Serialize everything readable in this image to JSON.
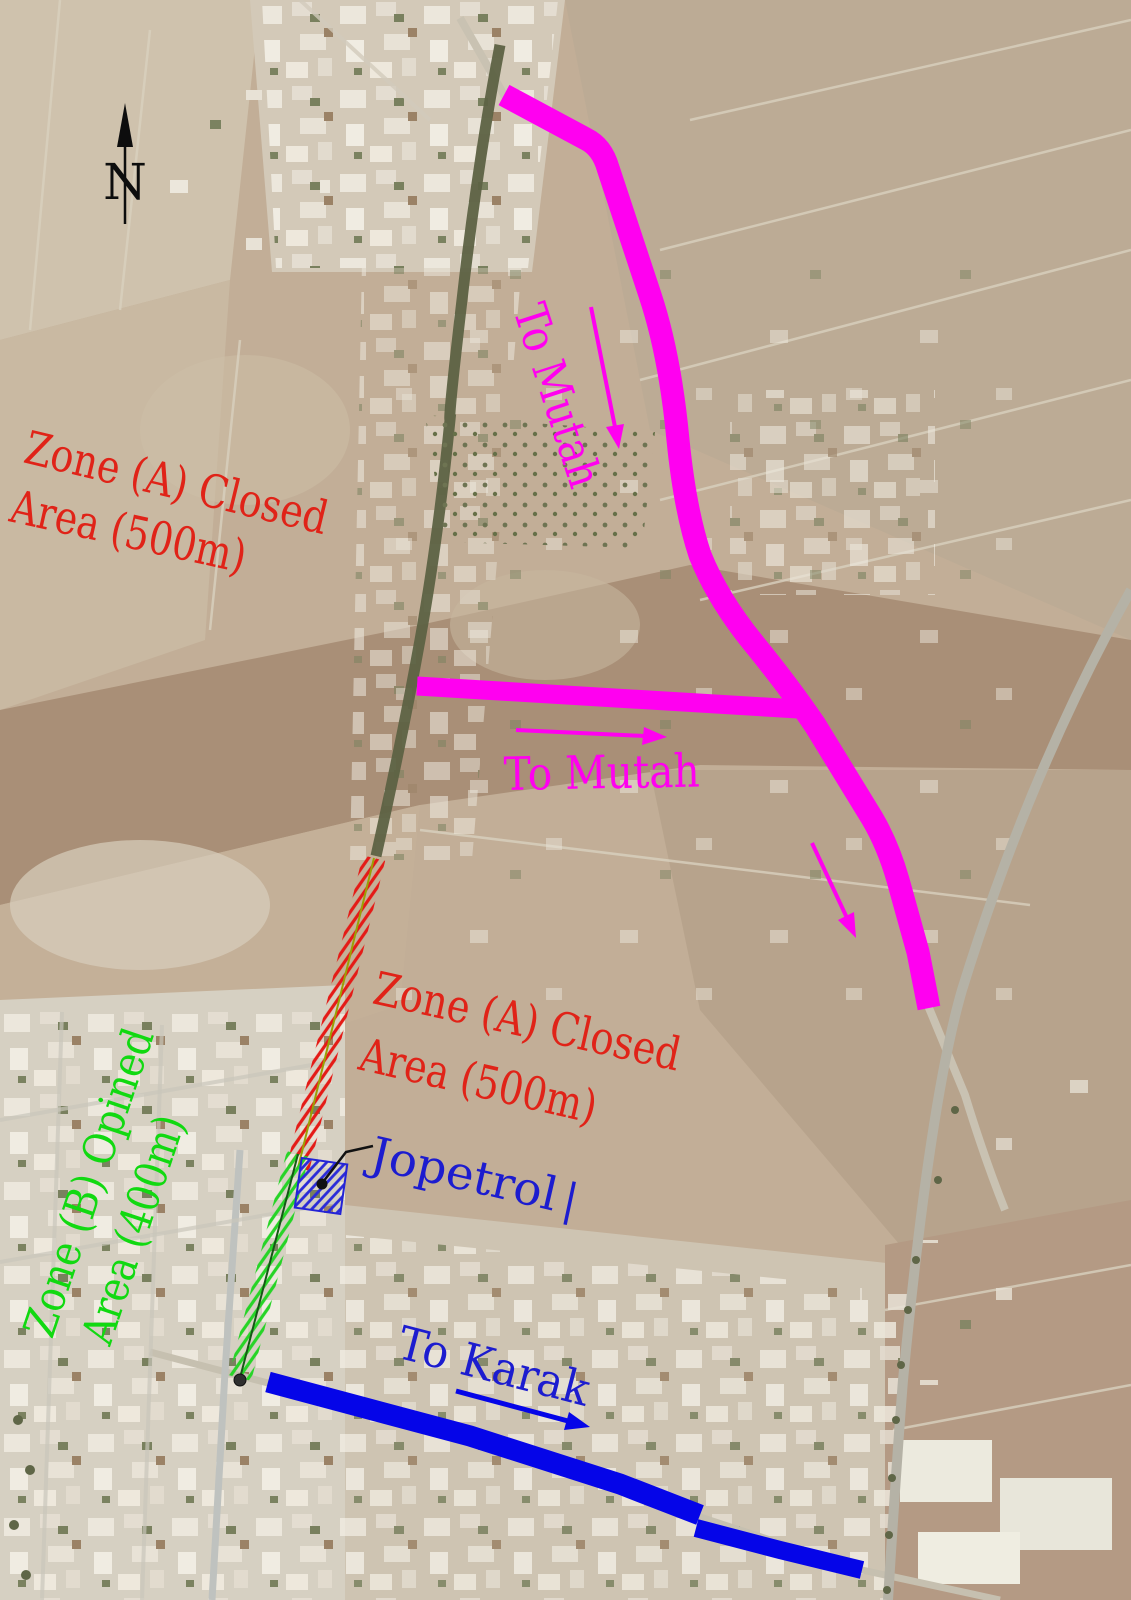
{
  "map": {
    "kind": "satellite annotation map - road closure and detour plan",
    "compass": {
      "label": "N"
    },
    "zones": {
      "zone_a_upper": {
        "line1": "Zone (A) Closed",
        "line2": "Area (500m)"
      },
      "zone_a_road": {
        "line1": "Zone (A) Closed",
        "line2": "Area (500m)"
      },
      "zone_b": {
        "line1": "Zone (B) Opined",
        "line2": "Area (400m)"
      }
    },
    "routes": {
      "to_mutah_upper": {
        "label": "To Mutah"
      },
      "to_mutah_branch": {
        "label": "To Mutah"
      },
      "to_karak": {
        "label": "To Karak"
      }
    },
    "poi": {
      "jopetrol": {
        "label": "Jopetrol",
        "cursor": "|"
      }
    }
  },
  "colors": {
    "magenta": "#ff00f0",
    "blue_route": "#0505e8",
    "blue_label": "#1c1ccf",
    "red_label": "#e02318",
    "green_label": "#11d911",
    "red_hatch": "#e41b17",
    "green_hatch": "#27d427",
    "blue_hatch": "#2a2ad8",
    "compass_black": "#0d0d0d"
  }
}
